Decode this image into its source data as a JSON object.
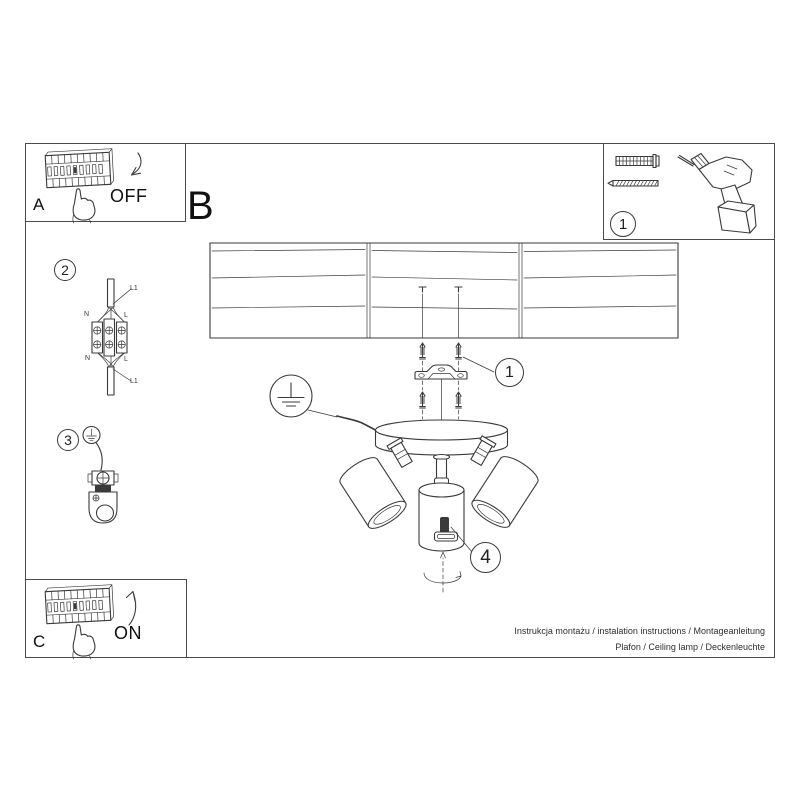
{
  "page": {
    "background": "#ffffff",
    "ink": "#3a3a3a",
    "border": "#4a4a4a"
  },
  "steps": {
    "b_label": "B",
    "panel_a": {
      "letter": "A",
      "state": "OFF"
    },
    "panel_c": {
      "letter": "C",
      "state": "ON"
    },
    "tools": {
      "number": "1",
      "anchor_qty": "x2"
    },
    "wiring": {
      "number": "2",
      "labels": {
        "l1_top": "L1",
        "n_top": "N",
        "l_top": "L",
        "n_bottom": "N",
        "l_bottom": "L",
        "l1_bottom": "L1"
      }
    },
    "ground": {
      "number": "3"
    },
    "bracket": {
      "number": "1"
    },
    "adjust": {
      "number": "4"
    }
  },
  "footer": {
    "line1": "Instrukcja montażu / instalation instructions / Montageanleitung",
    "line2": "Plafon / Ceiling lamp / Deckenleuchte"
  }
}
